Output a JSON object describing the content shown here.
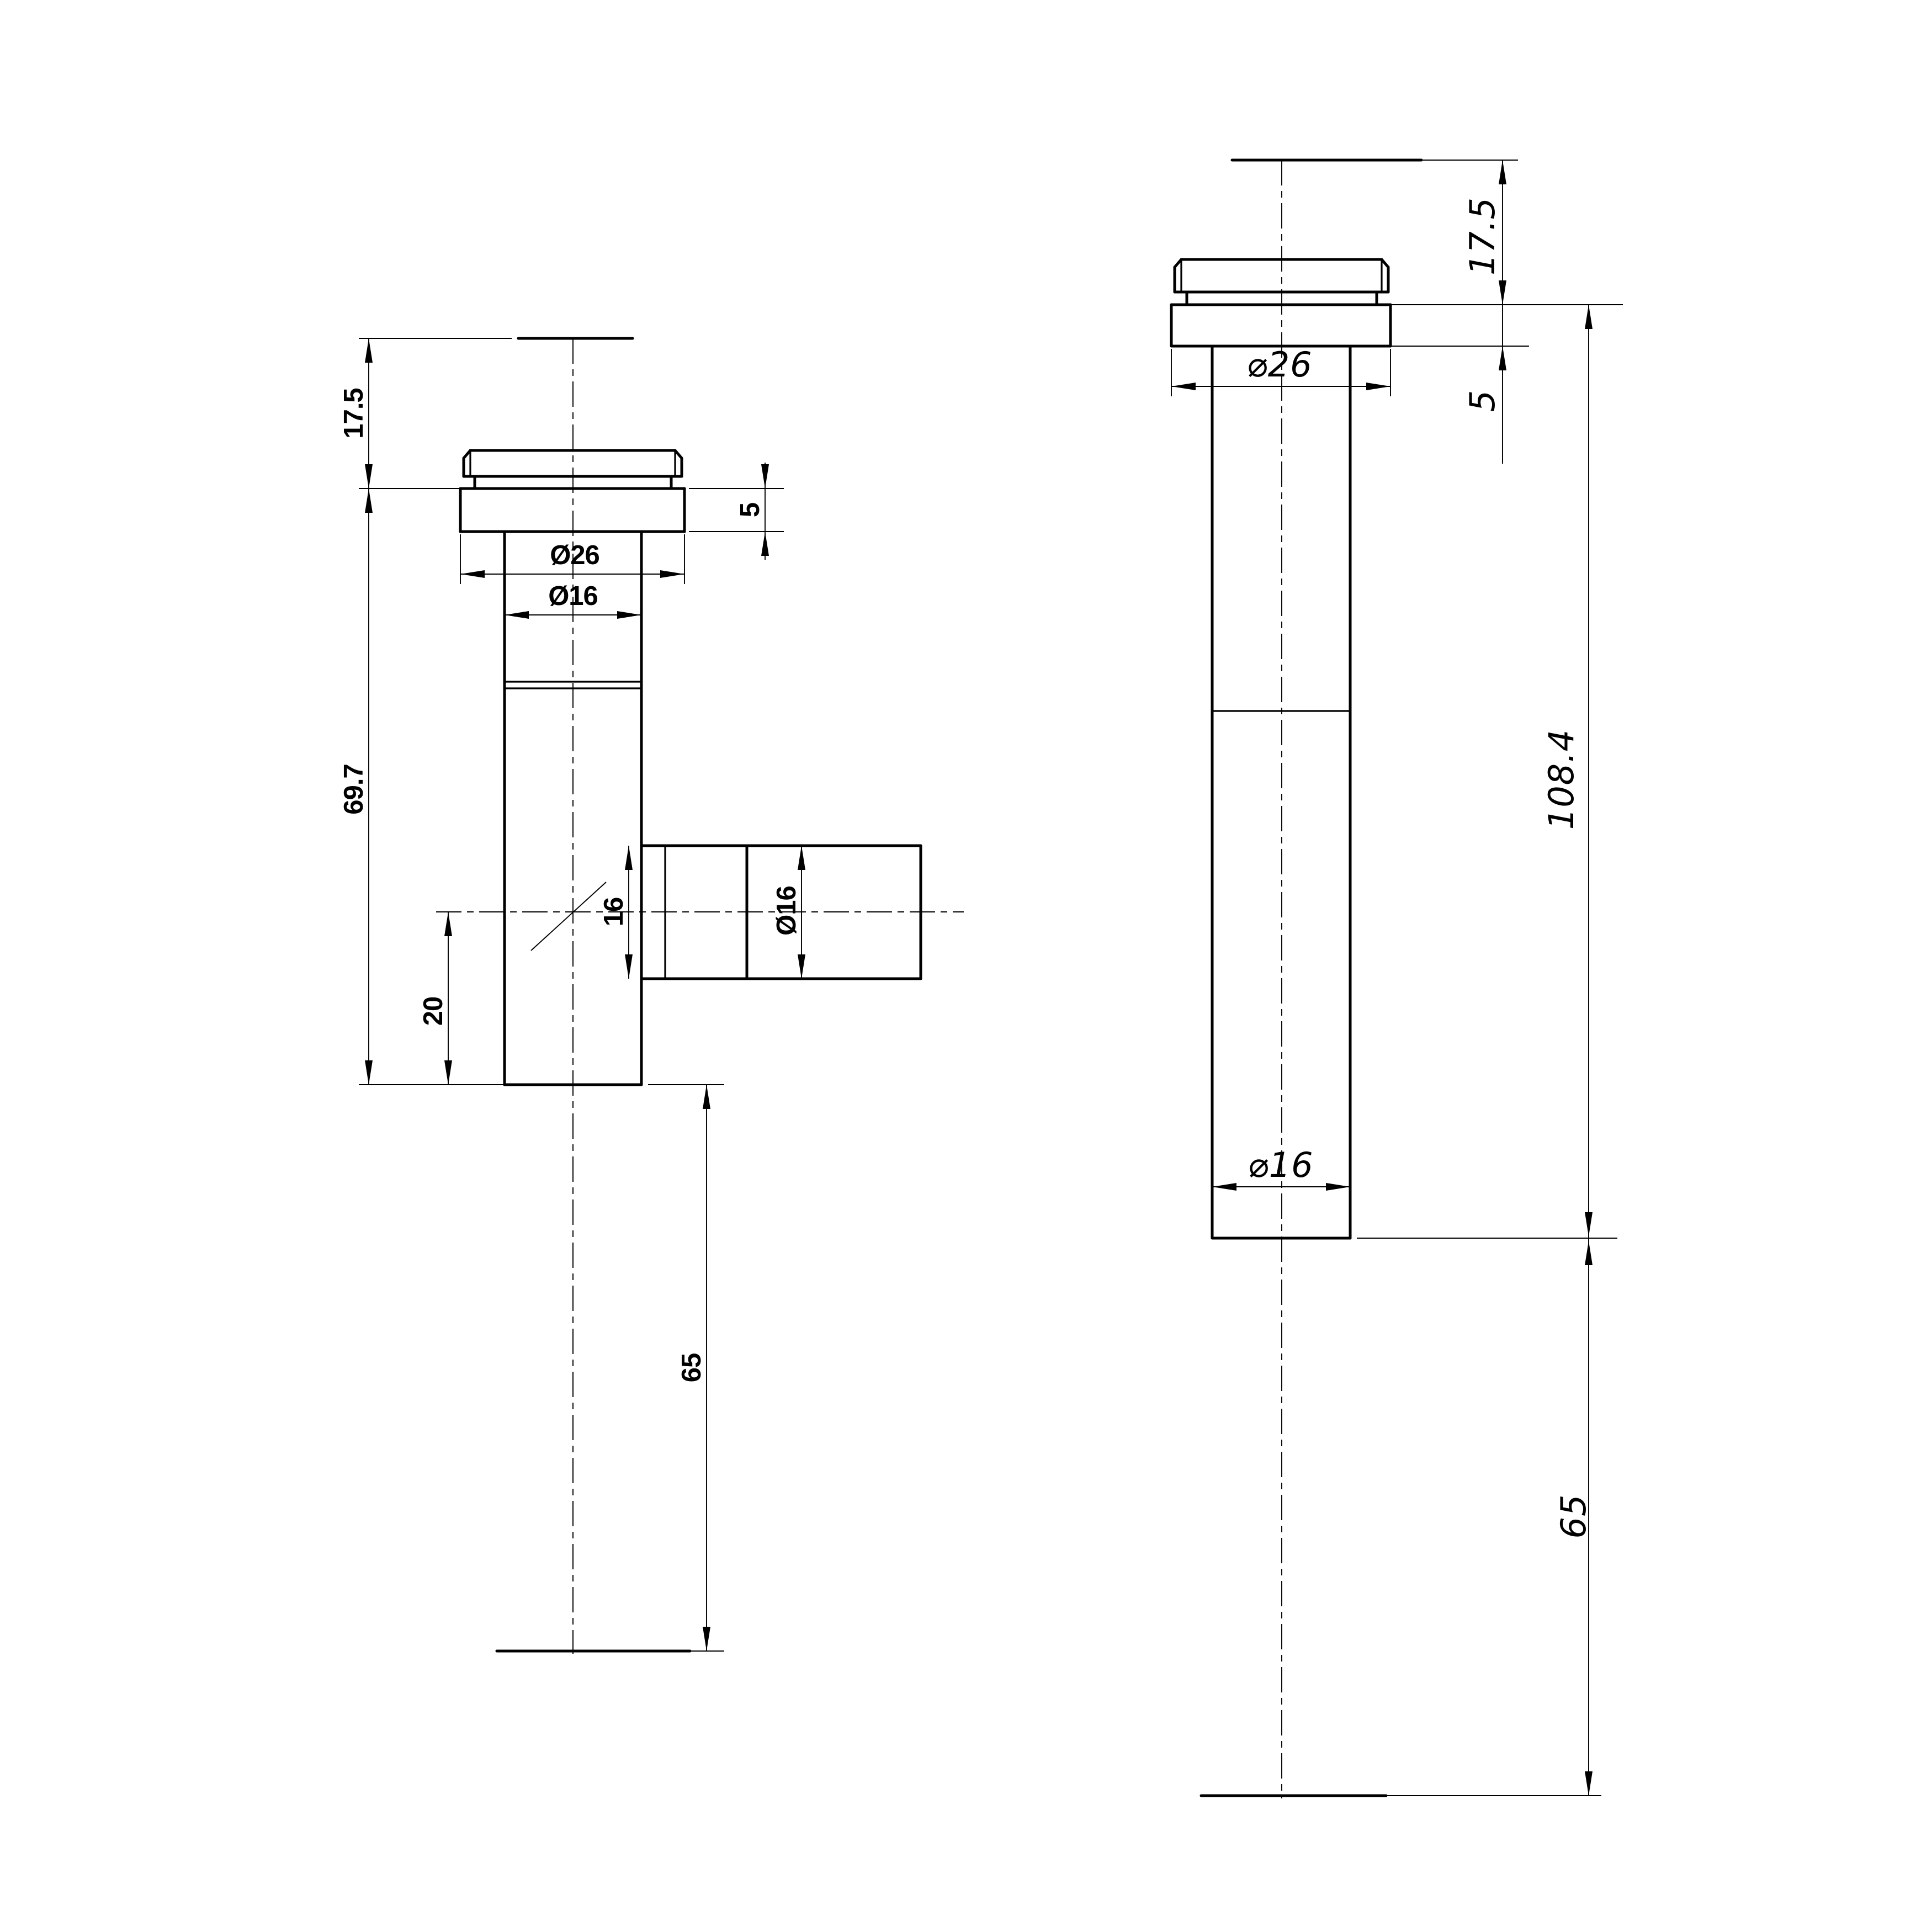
{
  "drawing": {
    "type": "2D CAD technical drawing, two orthographic views of a flanged tube fitting",
    "background": "#ffffff",
    "ink": "#000000"
  },
  "front_view": {
    "name": "front view with side outlet (T-fitting)",
    "labels": {
      "cap_height": "17.5",
      "body_length": "69.7",
      "outlet_offset": "20",
      "outlet_bore": "16",
      "outlet_diameter": "Ø16",
      "flange_thickness": "5",
      "flange_diameter": "Ø26",
      "tube_diameter": "Ø16",
      "tail_length": "65"
    }
  },
  "side_view": {
    "name": "side view, straight tube",
    "labels": {
      "cap_height": "17.5",
      "flange_thickness": "5",
      "flange_diameter": "⌀26",
      "overall_length": "108.4",
      "tube_diameter": "⌀16",
      "tail_length": "65"
    }
  }
}
